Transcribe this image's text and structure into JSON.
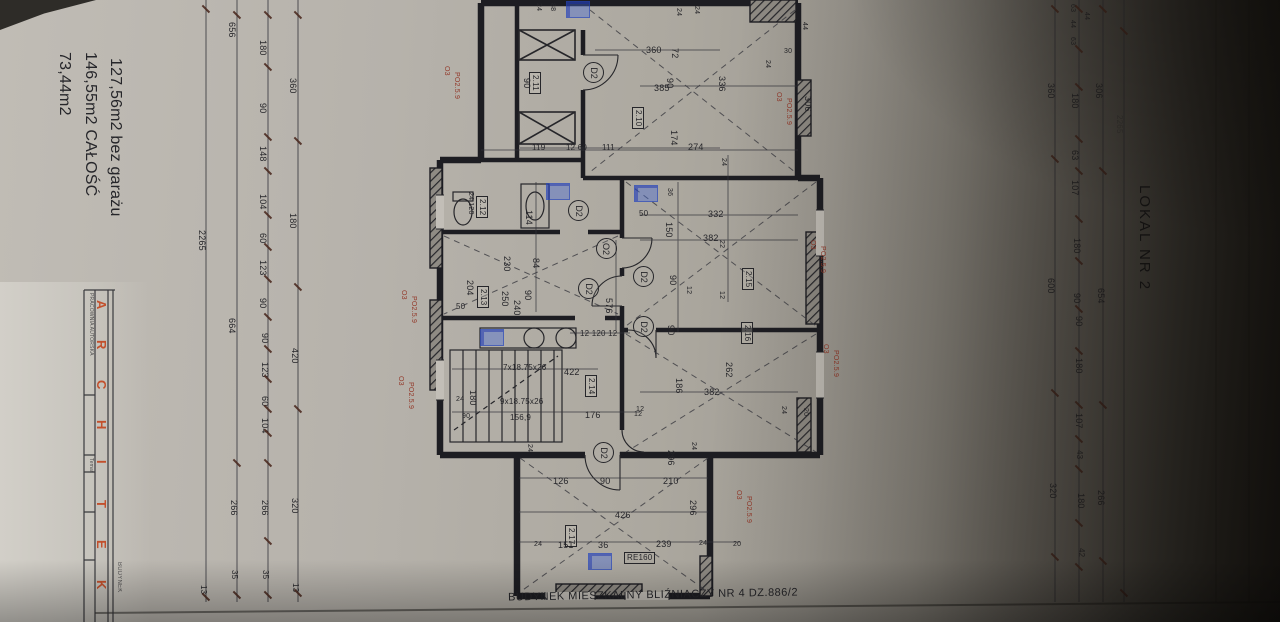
{
  "colors": {
    "paper": "#b3afa8",
    "ink": "#26262a",
    "red_annotation": "#93392a",
    "brand_red": "#c3502c",
    "blue_marker": "#3e66de"
  },
  "areas": {
    "line1": "73,44m2",
    "line2": "146,55m2 CAŁOŚĆ",
    "line3": "127,56m2 bez garażu"
  },
  "side_label": "LOKAL NR 2",
  "bottom_label": "BUDYNEK MIESZKALNY BLIŹNIACZY NR 4 DZ.886/2",
  "title_block": {
    "letters": [
      "A",
      "R",
      "C",
      "H",
      "I",
      "T",
      "E",
      "K"
    ],
    "office": "PRACOWNIA AUTORSKA",
    "temat": "Temat",
    "project_column": "BUDYNEK"
  },
  "rooms": [
    "2.10",
    "2.11",
    "2.12",
    "2.13",
    "2.14",
    "2.15",
    "2.16",
    "2.17"
  ],
  "door_symbols": [
    "D2",
    "O2"
  ],
  "stair_notes": [
    "7x18.75x26",
    "9x18.75x26",
    "156,9"
  ],
  "lintel_note": "RE160",
  "red_note": [
    "O3",
    "PO2.5.9"
  ],
  "labels": [
    {
      "t": "2265",
      "x": 206,
      "y": 230,
      "r": 1
    },
    {
      "t": "13",
      "x": 207,
      "y": 585,
      "r": 1,
      "s": 8
    },
    {
      "t": "656",
      "x": 236,
      "y": 22,
      "r": 1
    },
    {
      "t": "664",
      "x": 236,
      "y": 318,
      "r": 1
    },
    {
      "t": "266",
      "x": 238,
      "y": 500,
      "r": 1
    },
    {
      "t": "35",
      "x": 238,
      "y": 570,
      "r": 1,
      "s": 8
    },
    {
      "t": "180",
      "x": 267,
      "y": 40,
      "r": 1
    },
    {
      "t": "90",
      "x": 267,
      "y": 103,
      "r": 1
    },
    {
      "t": "148",
      "x": 267,
      "y": 146,
      "r": 1
    },
    {
      "t": "104",
      "x": 267,
      "y": 194,
      "r": 1
    },
    {
      "t": "60",
      "x": 267,
      "y": 233,
      "r": 1
    },
    {
      "t": "123",
      "x": 267,
      "y": 260,
      "r": 1
    },
    {
      "t": "90",
      "x": 267,
      "y": 298,
      "r": 1
    },
    {
      "t": "90",
      "x": 269,
      "y": 333,
      "r": 1
    },
    {
      "t": "123",
      "x": 269,
      "y": 362,
      "r": 1
    },
    {
      "t": "60",
      "x": 269,
      "y": 396,
      "r": 1
    },
    {
      "t": "104",
      "x": 269,
      "y": 418,
      "r": 1
    },
    {
      "t": "266",
      "x": 269,
      "y": 500,
      "r": 1
    },
    {
      "t": "35",
      "x": 269,
      "y": 570,
      "r": 1,
      "s": 8
    },
    {
      "t": "360",
      "x": 297,
      "y": 78,
      "r": 1
    },
    {
      "t": "180",
      "x": 297,
      "y": 213,
      "r": 1
    },
    {
      "t": "420",
      "x": 299,
      "y": 348,
      "r": 1
    },
    {
      "t": "320",
      "x": 299,
      "y": 498,
      "r": 1
    },
    {
      "t": "13",
      "x": 299,
      "y": 583,
      "r": 1,
      "s": 8
    },
    {
      "t": "63",
      "x": 1076,
      "y": 4,
      "r": 1,
      "s": 7
    },
    {
      "t": "44",
      "x": 1076,
      "y": 20,
      "r": 1,
      "s": 7
    },
    {
      "t": "63",
      "x": 1076,
      "y": 37,
      "r": 1,
      "s": 7
    },
    {
      "t": "44",
      "x": 1090,
      "y": 12,
      "r": 1,
      "s": 7
    },
    {
      "t": "180",
      "x": 1079,
      "y": 93,
      "r": 1
    },
    {
      "t": "63",
      "x": 1079,
      "y": 150,
      "r": 1
    },
    {
      "t": "107",
      "x": 1079,
      "y": 180,
      "r": 1
    },
    {
      "t": "180",
      "x": 1081,
      "y": 238,
      "r": 1
    },
    {
      "t": "90",
      "x": 1081,
      "y": 293,
      "r": 1
    },
    {
      "t": "90",
      "x": 1083,
      "y": 316,
      "r": 1
    },
    {
      "t": "180",
      "x": 1083,
      "y": 358,
      "r": 1
    },
    {
      "t": "107",
      "x": 1083,
      "y": 413,
      "r": 1
    },
    {
      "t": "43",
      "x": 1083,
      "y": 450,
      "r": 1,
      "s": 8
    },
    {
      "t": "180",
      "x": 1085,
      "y": 493,
      "r": 1
    },
    {
      "t": "42",
      "x": 1085,
      "y": 548,
      "r": 1,
      "s": 8
    },
    {
      "t": "306",
      "x": 1103,
      "y": 83,
      "r": 1
    },
    {
      "t": "654",
      "x": 1105,
      "y": 288,
      "r": 1
    },
    {
      "t": "266",
      "x": 1105,
      "y": 490,
      "r": 1
    },
    {
      "t": "360",
      "x": 1055,
      "y": 83,
      "r": 1
    },
    {
      "t": "600",
      "x": 1055,
      "y": 278,
      "r": 1
    },
    {
      "t": "320",
      "x": 1057,
      "y": 483,
      "r": 1
    },
    {
      "t": "2265",
      "x": 1123,
      "y": 115,
      "r": 1,
      "s": 8,
      "c": "faint"
    },
    {
      "t": "24",
      "x": 542,
      "y": 3,
      "r": 1,
      "s": 7
    },
    {
      "t": "88",
      "x": 556,
      "y": 3,
      "r": 1,
      "s": 7
    },
    {
      "t": "24",
      "x": 682,
      "y": 8,
      "r": 1,
      "s": 7
    },
    {
      "t": "24",
      "x": 700,
      "y": 6,
      "r": 1,
      "s": 7
    },
    {
      "t": "44",
      "x": 808,
      "y": 22,
      "r": 1,
      "s": 7
    },
    {
      "t": "30",
      "x": 784,
      "y": 48,
      "r": 0,
      "s": 7
    },
    {
      "t": "24",
      "x": 771,
      "y": 60,
      "r": 1,
      "s": 7
    },
    {
      "t": "360",
      "x": 646,
      "y": 46,
      "r": 0
    },
    {
      "t": "72",
      "x": 679,
      "y": 48,
      "r": 1
    },
    {
      "t": "385",
      "x": 654,
      "y": 84,
      "r": 0
    },
    {
      "t": "90",
      "x": 674,
      "y": 78,
      "r": 1
    },
    {
      "t": "336",
      "x": 726,
      "y": 76,
      "r": 1
    },
    {
      "t": "90",
      "x": 531,
      "y": 78,
      "r": 1
    },
    {
      "t": "2.11",
      "x": 541,
      "y": 72,
      "r": 1,
      "s": 8,
      "k": "room"
    },
    {
      "t": "2.10",
      "x": 644,
      "y": 107,
      "r": 1,
      "s": 8,
      "k": "room"
    },
    {
      "t": "174",
      "x": 678,
      "y": 130,
      "r": 1
    },
    {
      "t": "274",
      "x": 688,
      "y": 143,
      "r": 0
    },
    {
      "t": "119",
      "x": 532,
      "y": 144,
      "r": 0,
      "s": 8
    },
    {
      "t": "12 60",
      "x": 566,
      "y": 144,
      "r": 0,
      "s": 8
    },
    {
      "t": "111",
      "x": 602,
      "y": 144,
      "r": 0,
      "s": 8
    },
    {
      "t": "306",
      "x": 812,
      "y": 96,
      "r": 1
    },
    {
      "t": "24 120",
      "x": 474,
      "y": 192,
      "r": 1,
      "s": 7
    },
    {
      "t": "2.12",
      "x": 488,
      "y": 196,
      "r": 1,
      "s": 8,
      "k": "room"
    },
    {
      "t": "114",
      "x": 533,
      "y": 210,
      "r": 1
    },
    {
      "t": "230",
      "x": 511,
      "y": 256,
      "r": 1
    },
    {
      "t": "84",
      "x": 540,
      "y": 258,
      "r": 1
    },
    {
      "t": "204",
      "x": 474,
      "y": 280,
      "r": 1
    },
    {
      "t": "2.13",
      "x": 489,
      "y": 286,
      "r": 1,
      "s": 8,
      "k": "room"
    },
    {
      "t": "250",
      "x": 509,
      "y": 291,
      "r": 1
    },
    {
      "t": "240",
      "x": 521,
      "y": 300,
      "r": 1
    },
    {
      "t": "90",
      "x": 532,
      "y": 290,
      "r": 1
    },
    {
      "t": "50",
      "x": 456,
      "y": 303,
      "r": 0,
      "s": 8
    },
    {
      "t": "576",
      "x": 613,
      "y": 298,
      "r": 1
    },
    {
      "t": "12 120 12",
      "x": 580,
      "y": 330,
      "r": 0,
      "s": 8
    },
    {
      "t": "7x18.75x26",
      "x": 503,
      "y": 364,
      "r": 0,
      "s": 8,
      "k": "stair"
    },
    {
      "t": "422",
      "x": 564,
      "y": 368,
      "r": 0
    },
    {
      "t": "2.14",
      "x": 597,
      "y": 375,
      "r": 1,
      "s": 8,
      "k": "room"
    },
    {
      "t": "24",
      "x": 456,
      "y": 396,
      "r": 0,
      "s": 7
    },
    {
      "t": "180",
      "x": 477,
      "y": 390,
      "r": 1
    },
    {
      "t": "90",
      "x": 462,
      "y": 413,
      "r": 0,
      "s": 7
    },
    {
      "t": "9x18.75x26",
      "x": 500,
      "y": 398,
      "r": 0,
      "s": 8,
      "k": "stair"
    },
    {
      "t": "156,9",
      "x": 510,
      "y": 414,
      "r": 0,
      "s": 8,
      "k": "stair"
    },
    {
      "t": "176",
      "x": 585,
      "y": 411,
      "r": 0
    },
    {
      "t": "12",
      "x": 634,
      "y": 411,
      "r": 0,
      "s": 7
    },
    {
      "t": "24",
      "x": 727,
      "y": 158,
      "r": 1,
      "s": 7
    },
    {
      "t": "50",
      "x": 639,
      "y": 210,
      "r": 0,
      "s": 8
    },
    {
      "t": "332",
      "x": 708,
      "y": 210,
      "r": 0
    },
    {
      "t": "36",
      "x": 673,
      "y": 188,
      "r": 1,
      "s": 7
    },
    {
      "t": "150",
      "x": 673,
      "y": 222,
      "r": 1
    },
    {
      "t": "382",
      "x": 703,
      "y": 234,
      "r": 0
    },
    {
      "t": "22",
      "x": 725,
      "y": 240,
      "r": 1,
      "s": 7
    },
    {
      "t": "2.15",
      "x": 754,
      "y": 268,
      "r": 1,
      "s": 8,
      "k": "room"
    },
    {
      "t": "90",
      "x": 677,
      "y": 275,
      "r": 1
    },
    {
      "t": "12",
      "x": 692,
      "y": 286,
      "r": 1,
      "s": 7
    },
    {
      "t": "12",
      "x": 725,
      "y": 291,
      "r": 1,
      "s": 7
    },
    {
      "t": "90",
      "x": 675,
      "y": 325,
      "r": 1
    },
    {
      "t": "2.16",
      "x": 753,
      "y": 322,
      "r": 1,
      "s": 8,
      "k": "room"
    },
    {
      "t": "186",
      "x": 683,
      "y": 378,
      "r": 1
    },
    {
      "t": "262",
      "x": 733,
      "y": 362,
      "r": 1
    },
    {
      "t": "382",
      "x": 704,
      "y": 388,
      "r": 0
    },
    {
      "t": "24",
      "x": 787,
      "y": 406,
      "r": 1,
      "s": 7
    },
    {
      "t": "20",
      "x": 809,
      "y": 408,
      "r": 1,
      "s": 7
    },
    {
      "t": "12",
      "x": 636,
      "y": 406,
      "r": 0,
      "s": 7
    },
    {
      "t": "296",
      "x": 675,
      "y": 450,
      "r": 1
    },
    {
      "t": "24",
      "x": 697,
      "y": 442,
      "r": 1,
      "s": 7
    },
    {
      "t": "24",
      "x": 533,
      "y": 444,
      "r": 1,
      "s": 7
    },
    {
      "t": "126",
      "x": 553,
      "y": 477,
      "r": 0
    },
    {
      "t": "90",
      "x": 600,
      "y": 477,
      "r": 0
    },
    {
      "t": "210",
      "x": 663,
      "y": 477,
      "r": 0
    },
    {
      "t": "296",
      "x": 697,
      "y": 500,
      "r": 1
    },
    {
      "t": "426",
      "x": 615,
      "y": 511,
      "r": 0
    },
    {
      "t": "2.17",
      "x": 577,
      "y": 525,
      "r": 1,
      "s": 8,
      "k": "room"
    },
    {
      "t": "24",
      "x": 534,
      "y": 541,
      "r": 0,
      "s": 7
    },
    {
      "t": "151",
      "x": 558,
      "y": 541,
      "r": 0
    },
    {
      "t": "36",
      "x": 598,
      "y": 541,
      "r": 0
    },
    {
      "t": "239",
      "x": 656,
      "y": 540,
      "r": 0
    },
    {
      "t": "24",
      "x": 699,
      "y": 540,
      "r": 0,
      "s": 7
    },
    {
      "t": "20",
      "x": 733,
      "y": 541,
      "r": 0,
      "s": 7
    },
    {
      "t": "RE160",
      "x": 624,
      "y": 552,
      "r": 0,
      "s": 8,
      "k": "lintel"
    },
    {
      "t": "O3",
      "x": 450,
      "y": 66,
      "r": 1,
      "s": 7,
      "c": "red"
    },
    {
      "t": "PO2.5.9",
      "x": 460,
      "y": 72,
      "r": 1,
      "s": 7,
      "c": "red"
    },
    {
      "t": "O3",
      "x": 407,
      "y": 290,
      "r": 1,
      "s": 7,
      "c": "red"
    },
    {
      "t": "PO2.5.9",
      "x": 417,
      "y": 296,
      "r": 1,
      "s": 7,
      "c": "red"
    },
    {
      "t": "O3",
      "x": 404,
      "y": 376,
      "r": 1,
      "s": 7,
      "c": "red"
    },
    {
      "t": "PO2.5.9",
      "x": 414,
      "y": 382,
      "r": 1,
      "s": 7,
      "c": "red"
    },
    {
      "t": "O3",
      "x": 782,
      "y": 92,
      "r": 1,
      "s": 7,
      "c": "red"
    },
    {
      "t": "PO2.5.9",
      "x": 792,
      "y": 98,
      "r": 1,
      "s": 7,
      "c": "red"
    },
    {
      "t": "O3",
      "x": 816,
      "y": 240,
      "r": 1,
      "s": 7,
      "c": "red"
    },
    {
      "t": "PO2.5.9",
      "x": 826,
      "y": 246,
      "r": 1,
      "s": 7,
      "c": "red"
    },
    {
      "t": "O3",
      "x": 829,
      "y": 344,
      "r": 1,
      "s": 7,
      "c": "red"
    },
    {
      "t": "PO2.5.9",
      "x": 839,
      "y": 350,
      "r": 1,
      "s": 7,
      "c": "red"
    },
    {
      "t": "O3",
      "x": 742,
      "y": 490,
      "r": 1,
      "s": 7,
      "c": "red"
    },
    {
      "t": "PO2.5.9",
      "x": 752,
      "y": 496,
      "r": 1,
      "s": 7,
      "c": "red"
    }
  ],
  "door_circles": [
    {
      "t": "D2",
      "x": 583,
      "y": 62
    },
    {
      "t": "D2",
      "x": 568,
      "y": 200
    },
    {
      "t": "O2",
      "x": 596,
      "y": 238
    },
    {
      "t": "D2",
      "x": 578,
      "y": 278
    },
    {
      "t": "D2",
      "x": 633,
      "y": 266
    },
    {
      "t": "D2",
      "x": 633,
      "y": 316
    },
    {
      "t": "D2",
      "x": 593,
      "y": 442
    }
  ],
  "ticks": [
    [
      268,
      14
    ],
    [
      268,
      66
    ],
    [
      268,
      136
    ],
    [
      268,
      170
    ],
    [
      268,
      214
    ],
    [
      268,
      246
    ],
    [
      268,
      278
    ],
    [
      268,
      316
    ],
    [
      268,
      348
    ],
    [
      268,
      378
    ],
    [
      268,
      408
    ],
    [
      268,
      432
    ],
    [
      268,
      462
    ],
    [
      268,
      540
    ],
    [
      268,
      594
    ],
    [
      298,
      14
    ],
    [
      298,
      140
    ],
    [
      298,
      286
    ],
    [
      298,
      408
    ],
    [
      298,
      592
    ],
    [
      237,
      14
    ],
    [
      237,
      462
    ],
    [
      237,
      594
    ],
    [
      206,
      8
    ],
    [
      206,
      596
    ],
    [
      1079,
      8
    ],
    [
      1079,
      48
    ],
    [
      1079,
      86
    ],
    [
      1079,
      138
    ],
    [
      1079,
      170
    ],
    [
      1079,
      218
    ],
    [
      1079,
      260
    ],
    [
      1079,
      308
    ],
    [
      1079,
      350
    ],
    [
      1079,
      404
    ],
    [
      1079,
      438
    ],
    [
      1079,
      468
    ],
    [
      1079,
      522
    ],
    [
      1079,
      566
    ],
    [
      1103,
      8
    ],
    [
      1103,
      170
    ],
    [
      1103,
      404
    ],
    [
      1103,
      560
    ],
    [
      1055,
      8
    ],
    [
      1055,
      158
    ],
    [
      1055,
      392
    ],
    [
      1055,
      556
    ],
    [
      1124,
      30
    ],
    [
      1124,
      592
    ]
  ],
  "blue_marks": [
    [
      566,
      1
    ],
    [
      546,
      183
    ],
    [
      634,
      185
    ],
    [
      480,
      329
    ],
    [
      588,
      553
    ]
  ]
}
